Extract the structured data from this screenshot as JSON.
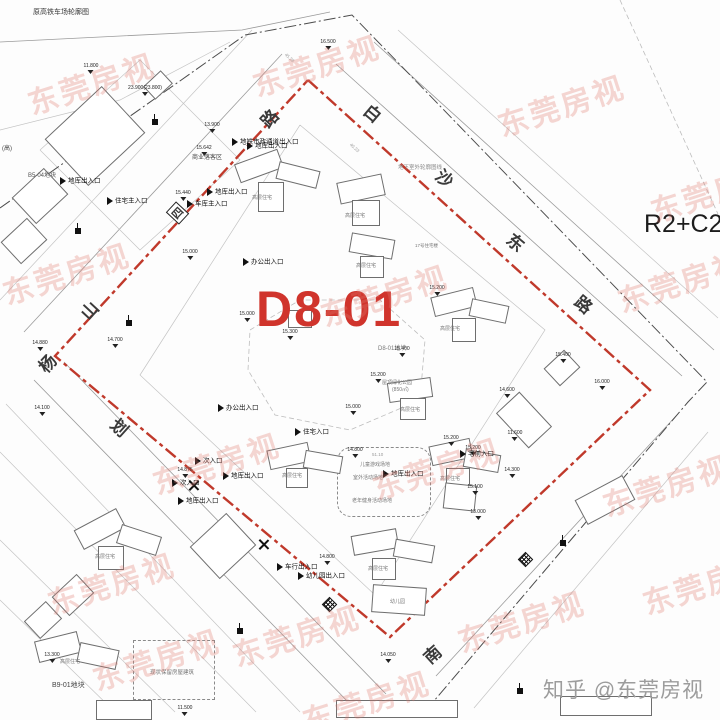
{
  "page": {
    "top_note": "原高铁车场轮廓图",
    "left_note": "(高)",
    "zoning": "R2+C2",
    "site_code": "D8-01",
    "credit": "知乎 @东莞房视",
    "watermark_text": "东莞房视"
  },
  "colors": {
    "boundary_red": "#c0392b",
    "site_label_red": "#d0342c",
    "watermark_pink": "#e07a6f",
    "line_gray": "#9b9b9b",
    "credit_gray": "#9c9c9c"
  },
  "boundaries": {
    "site_red_polygon": [
      [
        308,
        80
      ],
      [
        650,
        390
      ],
      [
        390,
        637
      ],
      [
        55,
        356
      ]
    ],
    "outer_dashdot": [
      [
        0,
        208
      ],
      [
        245,
        35
      ],
      [
        352,
        15
      ],
      [
        707,
        382
      ],
      [
        688,
        402
      ],
      [
        428,
        708
      ]
    ]
  },
  "lines": [
    {
      "c": "g1",
      "p": [
        [
          336,
          64
        ],
        [
          682,
          376
        ]
      ]
    },
    {
      "c": "g1",
      "p": [
        [
          374,
          42
        ],
        [
          714,
          350
        ]
      ]
    },
    {
      "c": "g2",
      "p": [
        [
          398,
          30
        ],
        [
          718,
          318
        ]
      ]
    },
    {
      "c": "dash",
      "p": [
        [
          620,
          0
        ],
        [
          718,
          214
        ]
      ]
    },
    {
      "c": "g1",
      "p": [
        [
          24,
          332
        ],
        [
          282,
          54
        ]
      ]
    },
    {
      "c": "g2",
      "p": [
        [
          0,
          300
        ],
        [
          252,
          30
        ]
      ]
    },
    {
      "c": "g1",
      "p": [
        [
          34,
          380
        ],
        [
          352,
          706
        ]
      ]
    },
    {
      "c": "g2",
      "p": [
        [
          6,
          404
        ],
        [
          300,
          712
        ]
      ]
    },
    {
      "c": "g1",
      "p": [
        [
          64,
          362
        ],
        [
          386,
          694
        ]
      ]
    },
    {
      "c": "g1",
      "p": [
        [
          676,
          416
        ],
        [
          436,
          676
        ]
      ]
    },
    {
      "c": "g2",
      "p": [
        [
          708,
          432
        ],
        [
          474,
          708
        ]
      ]
    },
    {
      "c": "g2",
      "p": [
        [
          0,
          452
        ],
        [
          256,
          712
        ]
      ]
    },
    {
      "c": "g2",
      "p": [
        [
          0,
          540
        ],
        [
          175,
          712
        ]
      ]
    },
    {
      "c": "g2",
      "p": [
        [
          0,
          600
        ],
        [
          115,
          712
        ]
      ]
    },
    {
      "c": "g1",
      "p": [
        [
          0,
          42
        ],
        [
          242,
          30
        ],
        [
          330,
          12
        ]
      ]
    },
    {
      "c": "g2",
      "p": [
        [
          0,
          130
        ],
        [
          120,
          100
        ],
        [
          230,
          42
        ]
      ]
    },
    {
      "c": "g2",
      "p": [
        [
          40,
          150
        ],
        [
          140,
          60
        ],
        [
          240,
          160
        ],
        [
          140,
          250
        ],
        [
          40,
          150
        ]
      ]
    },
    {
      "c": "g2",
      "p": [
        [
          300,
          125
        ],
        [
          545,
          330
        ],
        [
          375,
          595
        ],
        [
          140,
          375
        ],
        [
          300,
          125
        ]
      ]
    },
    {
      "c": "dash",
      "p": [
        [
          250,
          330
        ],
        [
          300,
          300
        ],
        [
          380,
          300
        ],
        [
          425,
          340
        ],
        [
          420,
          400
        ],
        [
          350,
          430
        ],
        [
          275,
          415
        ],
        [
          248,
          370
        ],
        [
          250,
          330
        ]
      ]
    }
  ],
  "road_chars": [
    {
      "t": "白",
      "x": 365,
      "y": 100,
      "r": 40
    },
    {
      "t": "沙",
      "x": 437,
      "y": 165,
      "r": 40
    },
    {
      "t": "东",
      "x": 508,
      "y": 229,
      "r": 40
    },
    {
      "t": "路",
      "x": 576,
      "y": 291,
      "r": 40
    },
    {
      "t": "路",
      "x": 260,
      "y": 105,
      "r": -47
    },
    {
      "t": "山",
      "x": 80,
      "y": 297,
      "r": -47
    },
    {
      "t": "杨",
      "x": 38,
      "y": 350,
      "r": -47
    },
    {
      "t": "划",
      "x": 112,
      "y": 414,
      "r": 42
    },
    {
      "t": "南",
      "x": 423,
      "y": 641,
      "r": -42
    },
    {
      "t": "四",
      "x": 170,
      "y": 204,
      "r": -47,
      "boxed": true
    }
  ],
  "diamond_symbols": [
    [
      324,
      599
    ],
    [
      520,
      554
    ]
  ],
  "x_marks": [
    [
      188,
      480
    ],
    [
      258,
      539
    ]
  ],
  "flags": [
    [
      152,
      119
    ],
    [
      75,
      228
    ],
    [
      126,
      320
    ],
    [
      237,
      628
    ],
    [
      517,
      688
    ],
    [
      560,
      540
    ]
  ],
  "entrances": [
    {
      "t": "地库出入口",
      "x": 60,
      "y": 177
    },
    {
      "t": "住宅主入口",
      "x": 107,
      "y": 197
    },
    {
      "t": "地铁市政通道出入口",
      "x": 232,
      "y": 138
    },
    {
      "t": "地库出入口",
      "x": 247,
      "y": 142
    },
    {
      "t": "地库出入口",
      "x": 207,
      "y": 188
    },
    {
      "t": "车库主入口",
      "x": 187,
      "y": 200
    },
    {
      "t": "办公出入口",
      "x": 243,
      "y": 258
    },
    {
      "t": "办公出入口",
      "x": 218,
      "y": 404
    },
    {
      "t": "住宅入口",
      "x": 295,
      "y": 428
    },
    {
      "t": "次入口",
      "x": 195,
      "y": 457
    },
    {
      "t": "次入口",
      "x": 172,
      "y": 479
    },
    {
      "t": "地库出入口",
      "x": 223,
      "y": 472
    },
    {
      "t": "地库出入口",
      "x": 178,
      "y": 497
    },
    {
      "t": "地库出入口",
      "x": 383,
      "y": 470
    },
    {
      "t": "宅前入口",
      "x": 460,
      "y": 450
    },
    {
      "t": "车行出入口",
      "x": 277,
      "y": 563
    },
    {
      "t": "幼儿园出入口",
      "x": 298,
      "y": 572
    }
  ],
  "area_labels": [
    {
      "t": "原高铁车场轮廓图",
      "x": 33,
      "y": 7,
      "s": 7,
      "c": "#333"
    },
    {
      "t": "(高)",
      "x": 2,
      "y": 143,
      "s": 6,
      "c": "#444"
    },
    {
      "t": "B5-04地块",
      "x": 28,
      "y": 170,
      "s": 6,
      "c": "#555"
    },
    {
      "t": "B9-01地块",
      "x": 52,
      "y": 680,
      "s": 7,
      "c": "#444"
    },
    {
      "t": "D8-01地块",
      "x": 378,
      "y": 343,
      "s": 6,
      "c": "#777"
    },
    {
      "t": "商业落客区",
      "x": 192,
      "y": 152,
      "s": 6,
      "c": "#444"
    },
    {
      "t": "地下室外轮廓图线",
      "x": 398,
      "y": 163,
      "s": 5.5,
      "c": "#888"
    },
    {
      "t": "现状保留房屋建筑",
      "x": 150,
      "y": 668,
      "s": 5.5,
      "c": "#777"
    },
    {
      "t": "儿童游戏场地",
      "x": 360,
      "y": 461,
      "s": 5,
      "c": "#777"
    },
    {
      "t": "室外活动场地",
      "x": 353,
      "y": 474,
      "s": 5,
      "c": "#777"
    },
    {
      "t": "老年健身活动场地",
      "x": 352,
      "y": 497,
      "s": 5,
      "c": "#777"
    },
    {
      "t": "屋顶绿化公园",
      "x": 382,
      "y": 379,
      "s": 5,
      "c": "#777"
    },
    {
      "t": "(850㎡)",
      "x": 392,
      "y": 386,
      "s": 5,
      "c": "#777"
    },
    {
      "t": "高层住宅",
      "x": 252,
      "y": 194,
      "s": 5,
      "c": "#777"
    },
    {
      "t": "高层住宅",
      "x": 345,
      "y": 212,
      "s": 5,
      "c": "#777"
    },
    {
      "t": "高层住宅",
      "x": 356,
      "y": 262,
      "s": 5,
      "c": "#777"
    },
    {
      "t": "高层住宅",
      "x": 440,
      "y": 325,
      "s": 5,
      "c": "#777"
    },
    {
      "t": "17号住宅楼",
      "x": 415,
      "y": 243,
      "s": 4.5,
      "c": "#777"
    },
    {
      "t": "高层住宅",
      "x": 400,
      "y": 406,
      "s": 5,
      "c": "#777"
    },
    {
      "t": "高层住宅",
      "x": 440,
      "y": 475,
      "s": 5,
      "c": "#777"
    },
    {
      "t": "高层住宅",
      "x": 282,
      "y": 472,
      "s": 5,
      "c": "#777"
    },
    {
      "t": "高层住宅",
      "x": 368,
      "y": 565,
      "s": 5,
      "c": "#777"
    },
    {
      "t": "幼儿园",
      "x": 390,
      "y": 598,
      "s": 5,
      "c": "#777"
    },
    {
      "t": "高层住宅",
      "x": 95,
      "y": 553,
      "s": 5,
      "c": "#777"
    },
    {
      "t": "高层住宅",
      "x": 60,
      "y": 658,
      "s": 5,
      "c": "#777"
    },
    {
      "t": "45.28",
      "x": 287,
      "y": 52,
      "s": 4.5,
      "c": "#999",
      "r": 42
    },
    {
      "t": "40.23",
      "x": 352,
      "y": 142,
      "s": 4.5,
      "c": "#999",
      "r": 42
    },
    {
      "t": "51.10",
      "x": 372,
      "y": 452,
      "s": 4.5,
      "c": "#999",
      "r": 0
    }
  ],
  "elevations": [
    {
      "v": "11.800",
      "x": 91,
      "y": 64
    },
    {
      "v": "23.900(23.800)",
      "x": 145,
      "y": 86
    },
    {
      "v": "16.500",
      "x": 328,
      "y": 40
    },
    {
      "v": "13.900",
      "x": 212,
      "y": 123
    },
    {
      "v": "15.642",
      "x": 204,
      "y": 146
    },
    {
      "v": "15.440",
      "x": 183,
      "y": 191
    },
    {
      "v": "15.000",
      "x": 190,
      "y": 250
    },
    {
      "v": "15.000",
      "x": 247,
      "y": 312
    },
    {
      "v": "15.300",
      "x": 290,
      "y": 330
    },
    {
      "v": "15.400",
      "x": 402,
      "y": 347
    },
    {
      "v": "15.200",
      "x": 378,
      "y": 373
    },
    {
      "v": "15.000",
      "x": 353,
      "y": 405
    },
    {
      "v": "15.200",
      "x": 437,
      "y": 286
    },
    {
      "v": "16.000",
      "x": 602,
      "y": 380
    },
    {
      "v": "15.400",
      "x": 563,
      "y": 353
    },
    {
      "v": "14.600",
      "x": 507,
      "y": 388
    },
    {
      "v": "14.300",
      "x": 512,
      "y": 468
    },
    {
      "v": "11.600",
      "x": 515,
      "y": 431
    },
    {
      "v": "15.200",
      "x": 451,
      "y": 436
    },
    {
      "v": "15.200",
      "x": 473,
      "y": 446
    },
    {
      "v": "14.800",
      "x": 355,
      "y": 448
    },
    {
      "v": "14.875",
      "x": 185,
      "y": 468
    },
    {
      "v": "14.700",
      "x": 115,
      "y": 338
    },
    {
      "v": "14.880",
      "x": 40,
      "y": 341
    },
    {
      "v": "14.100",
      "x": 42,
      "y": 406
    },
    {
      "v": "14.800",
      "x": 327,
      "y": 555
    },
    {
      "v": "14.050",
      "x": 388,
      "y": 653
    },
    {
      "v": "13.300",
      "x": 52,
      "y": 653
    },
    {
      "v": "11.500",
      "x": 185,
      "y": 706
    },
    {
      "v": "15.100",
      "x": 475,
      "y": 485
    },
    {
      "v": "13.000",
      "x": 478,
      "y": 510
    }
  ],
  "buildings": [
    [
      236,
      156,
      44,
      18,
      -20
    ],
    [
      277,
      166,
      40,
      16,
      14
    ],
    [
      258,
      182,
      24,
      28,
      0
    ],
    [
      338,
      178,
      44,
      20,
      -12
    ],
    [
      352,
      200,
      26,
      24,
      0
    ],
    [
      350,
      236,
      42,
      18,
      10
    ],
    [
      360,
      256,
      22,
      20,
      0
    ],
    [
      288,
      310,
      22,
      16,
      0
    ],
    [
      432,
      292,
      42,
      18,
      -14
    ],
    [
      470,
      302,
      36,
      16,
      12
    ],
    [
      452,
      318,
      22,
      22,
      0
    ],
    [
      548,
      356,
      26,
      22,
      -43
    ],
    [
      388,
      380,
      42,
      18,
      -8
    ],
    [
      400,
      398,
      24,
      20,
      0
    ],
    [
      430,
      442,
      40,
      18,
      -12
    ],
    [
      464,
      452,
      34,
      16,
      10
    ],
    [
      446,
      468,
      22,
      18,
      0
    ],
    [
      268,
      446,
      40,
      18,
      -12
    ],
    [
      304,
      453,
      36,
      16,
      10
    ],
    [
      286,
      468,
      20,
      18,
      0
    ],
    [
      352,
      532,
      44,
      18,
      -10
    ],
    [
      394,
      542,
      38,
      16,
      10
    ],
    [
      372,
      558,
      22,
      20,
      0
    ],
    [
      372,
      586,
      52,
      26,
      4
    ],
    [
      508,
      396,
      30,
      46,
      -43
    ],
    [
      578,
      486,
      52,
      26,
      -28
    ],
    [
      444,
      484,
      30,
      24,
      6
    ],
    [
      56,
      104,
      76,
      62,
      -43
    ],
    [
      18,
      178,
      42,
      34,
      -43
    ],
    [
      6,
      226,
      34,
      28,
      -43
    ],
    [
      146,
      76,
      22,
      16,
      -43
    ],
    [
      76,
      518,
      46,
      20,
      -28
    ],
    [
      118,
      530,
      40,
      18,
      18
    ],
    [
      98,
      546,
      24,
      22,
      0
    ],
    [
      56,
      582,
      32,
      24,
      -43
    ],
    [
      28,
      608,
      28,
      22,
      -43
    ],
    [
      198,
      524,
      48,
      42,
      -43
    ],
    [
      36,
      636,
      42,
      20,
      -14
    ],
    [
      78,
      646,
      38,
      18,
      12
    ],
    [
      96,
      700,
      54,
      18,
      0
    ],
    [
      336,
      700,
      120,
      16,
      0
    ],
    [
      560,
      696,
      90,
      18,
      0
    ]
  ],
  "dashed_zones": [
    {
      "x": 337,
      "y": 447,
      "w": 92,
      "h": 68,
      "rounded": true
    },
    {
      "x": 133,
      "y": 640,
      "w": 80,
      "h": 58,
      "rounded": false
    }
  ],
  "watermarks": [
    [
      25,
      60
    ],
    [
      250,
      42
    ],
    [
      495,
      82
    ],
    [
      648,
      168
    ],
    [
      0,
      250
    ],
    [
      318,
      272
    ],
    [
      615,
      258
    ],
    [
      150,
      440
    ],
    [
      370,
      445
    ],
    [
      600,
      462
    ],
    [
      45,
      560
    ],
    [
      230,
      612
    ],
    [
      455,
      598
    ],
    [
      640,
      560
    ],
    [
      90,
      636
    ],
    [
      300,
      678
    ]
  ]
}
